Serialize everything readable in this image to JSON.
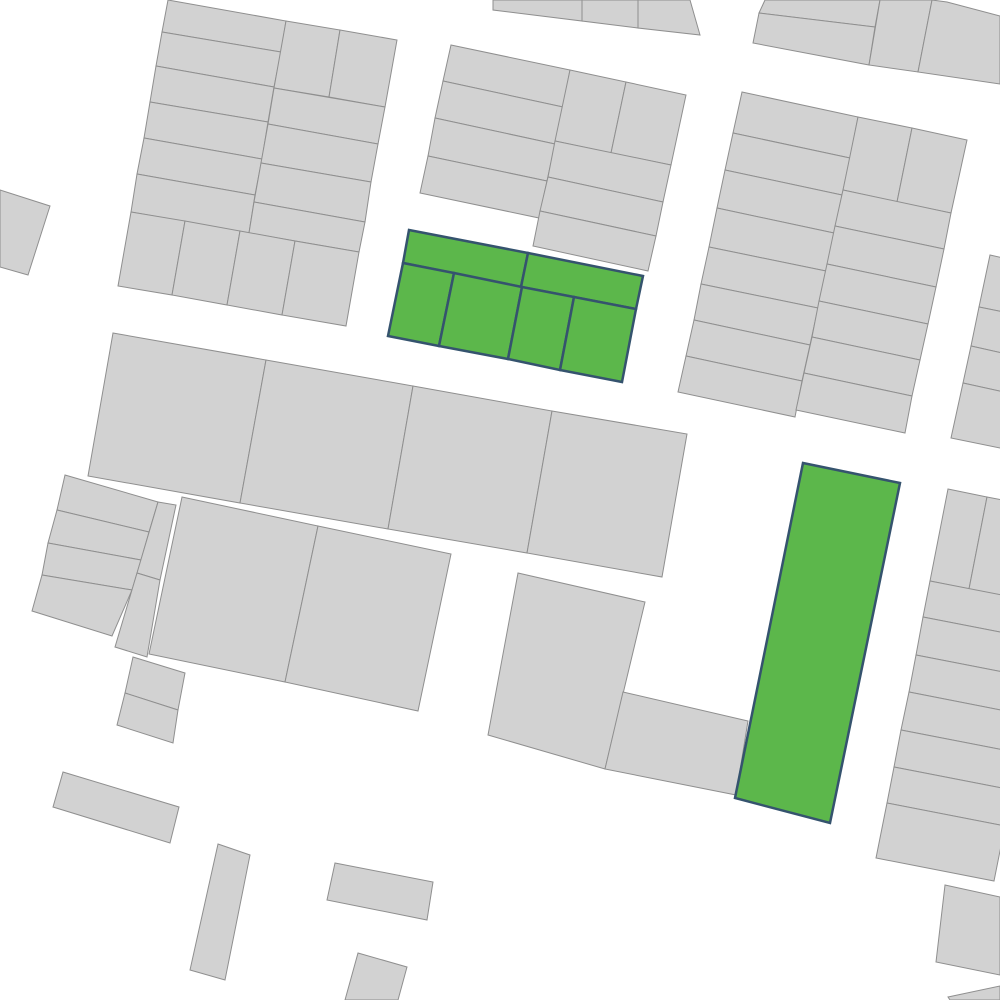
{
  "map": {
    "canvas": {
      "width": 1000,
      "height": 1000,
      "background": "#ffffff"
    },
    "styles": {
      "parcel_default": {
        "fill": "#d2d2d2",
        "stroke": "#8f8f8f",
        "stroke_width": 1
      },
      "parcel_highlighted": {
        "fill": "#5cb74b",
        "stroke": "#35536e",
        "stroke_width": 2.5
      }
    },
    "blocks": [
      {
        "name": "top-left-block",
        "parcels": [
          {
            "points": "168,0 286,21 281,52 162,32"
          },
          {
            "points": "162,32 281,52 274,87 156,66"
          },
          {
            "points": "156,66 274,87 268,122 150,102"
          },
          {
            "points": "150,102 268,122 262,159 144,138"
          },
          {
            "points": "144,138 262,159 255,195 137,174"
          },
          {
            "points": "137,174 255,195 249,233 131,212"
          },
          {
            "points": "286,21 340,30 329,97 274,88"
          },
          {
            "points": "340,30 397,40 385,107 329,97"
          },
          {
            "points": "274,88 385,107 378,144 268,124"
          },
          {
            "points": "268,124 378,144 371,182 261,163"
          },
          {
            "points": "261,163 371,182 365,222 254,202"
          },
          {
            "points": "254,202 365,222 359,252 249,233"
          },
          {
            "points": "131,212 185,221 172,295 118,286"
          },
          {
            "points": "185,221 240,231 227,305 172,295"
          },
          {
            "points": "240,231 295,241 282,315 227,305"
          },
          {
            "points": "295,241 359,252 346,326 282,315"
          }
        ]
      },
      {
        "name": "top-center-strip",
        "parcels": [
          {
            "points": "493,0 582,0 582,21 493,10"
          },
          {
            "points": "582,0 638,0 638,28 582,21"
          },
          {
            "points": "638,0 690,0 700,35 638,28"
          }
        ]
      },
      {
        "name": "top-right-strip",
        "parcels": [
          {
            "points": "765,0 880,0 875,27 759,13"
          },
          {
            "points": "759,13 875,27 869,65 753,43"
          },
          {
            "points": "880,0 932,0 918,72 869,65"
          },
          {
            "points": "932,0 947,2 1000,16 1000,84 918,72"
          }
        ]
      },
      {
        "name": "top-center-block",
        "parcels": [
          {
            "points": "451,45 570,70 563,107 443,81"
          },
          {
            "points": "443,81 563,107 555,144 435,118"
          },
          {
            "points": "435,118 555,144 547,181 428,156"
          },
          {
            "points": "428,156 547,181 539,218 420,193"
          },
          {
            "points": "570,70 626,82 611,153 555,141"
          },
          {
            "points": "626,82 686,95 671,165 611,153"
          },
          {
            "points": "555,141 671,165 663,202 548,177"
          },
          {
            "points": "548,177 663,202 656,236 540,211"
          },
          {
            "points": "540,211 656,236 648,271 533,246"
          }
        ]
      },
      {
        "name": "highlighted-block",
        "parcels": [
          {
            "points": "409,230 528,253 521,287 403,263",
            "highlighted": true
          },
          {
            "points": "528,253 643,276 636,309 521,287",
            "highlighted": true
          },
          {
            "points": "403,263 454,273 439,346 388,336",
            "highlighted": true
          },
          {
            "points": "454,273 522,287 508,359 439,346",
            "highlighted": true
          },
          {
            "points": "522,287 574,297 560,370 508,359",
            "highlighted": true
          },
          {
            "points": "574,297 636,309 622,382 560,370",
            "highlighted": true
          }
        ]
      },
      {
        "name": "big-right-block",
        "parcels": [
          {
            "points": "742,92 858,117 850,158 733,133"
          },
          {
            "points": "733,133 850,158 842,195 725,170"
          },
          {
            "points": "725,170 842,195 834,233 717,208"
          },
          {
            "points": "717,208 834,233 826,271 709,247"
          },
          {
            "points": "709,247 826,271 818,308 701,284"
          },
          {
            "points": "701,284 818,308 810,345 694,320"
          },
          {
            "points": "694,320 810,345 802,381 686,356"
          },
          {
            "points": "686,356 802,381 795,417 678,392"
          },
          {
            "points": "858,117 912,128 897,202 843,190"
          },
          {
            "points": "912,128 967,140 951,213 897,202"
          },
          {
            "points": "843,190 951,213 944,249 835,226"
          },
          {
            "points": "835,226 944,249 936,287 827,264"
          },
          {
            "points": "827,264 936,287 928,324 819,301"
          },
          {
            "points": "819,301 928,324 920,360 812,337"
          },
          {
            "points": "812,337 920,360 912,396 804,373"
          },
          {
            "points": "804,373 912,396 905,433 796,410"
          }
        ]
      },
      {
        "name": "right-edge-sliver-block",
        "parcels": [
          {
            "points": "990,255 1049,268 1038,319 979,307"
          },
          {
            "points": "979,307 1038,319 1029,359 971,346"
          },
          {
            "points": "971,346 1029,359 1022,396 963,383"
          },
          {
            "points": "963,383 1022,396 1010,450 951,438"
          }
        ]
      },
      {
        "name": "middle-band-block",
        "parcels": [
          {
            "points": "113,333 266,360 240,503 88,476"
          },
          {
            "points": "266,360 413,386 388,529 240,503"
          },
          {
            "points": "413,386 552,411 527,553 388,529"
          },
          {
            "points": "552,411 687,434 662,577 527,553"
          }
        ]
      },
      {
        "name": "left-edge-small-parcel",
        "parcels": [
          {
            "points": "0,190 50,206 28,275 0,267"
          }
        ]
      },
      {
        "name": "left-strips-block",
        "parcels": [
          {
            "points": "65,475 158,502 149,532 57,510"
          },
          {
            "points": "57,510 149,532 141,560 48,543"
          },
          {
            "points": "48,543 141,560 132,590 42,575"
          },
          {
            "points": "42,575 132,590 112,636 32,611"
          },
          {
            "points": "158,502 176,505 160,580 137,573"
          },
          {
            "points": "137,573 160,580 147,657 115,647"
          }
        ]
      },
      {
        "name": "lower-center-block",
        "parcels": [
          {
            "points": "182,497 318,526 285,682 149,654"
          },
          {
            "points": "318,526 451,554 418,711 285,682"
          }
        ]
      },
      {
        "name": "center-south-block",
        "parcels": [
          {
            "points": "518,573 645,602 605,769 488,735"
          },
          {
            "points": "623,692 748,721 736,795 605,769"
          }
        ]
      },
      {
        "name": "tall-highlighted-parcel",
        "parcels": [
          {
            "points": "803,463 900,483 830,823 735,798",
            "highlighted": true
          }
        ]
      },
      {
        "name": "right-bottom-block",
        "parcels": [
          {
            "points": "948,489 987,497 969,589 930,581"
          },
          {
            "points": "987,497 1066,512 1048,604 969,589"
          },
          {
            "points": "930,581 1048,604 1041,640 923,617"
          },
          {
            "points": "923,617 1041,640 1034,678 916,655"
          },
          {
            "points": "916,655 1034,678 1026,715 909,692"
          },
          {
            "points": "909,692 1026,715 1019,753 901,730"
          },
          {
            "points": "901,730 1019,753 1012,790 894,767"
          },
          {
            "points": "894,767 1012,790 1005,826 887,803"
          },
          {
            "points": "887,803 1005,826 994,881 876,858"
          }
        ]
      },
      {
        "name": "small-two-cell-block",
        "parcels": [
          {
            "points": "133,657 185,673 178,710 125,693"
          },
          {
            "points": "125,693 178,710 173,743 117,725"
          }
        ]
      },
      {
        "name": "scattered-south-parcels",
        "parcels": [
          {
            "points": "63,772 179,807 170,843 53,807"
          },
          {
            "points": "218,844 250,855 225,980 190,970"
          },
          {
            "points": "335,863 433,882 427,920 327,900"
          },
          {
            "points": "358,953 407,967 398,1000 345,1000"
          },
          {
            "points": "945,885 1000,897 1000,975 936,962"
          },
          {
            "points": "948,997 1000,986 1000,1000 950,1000"
          }
        ]
      }
    ]
  }
}
